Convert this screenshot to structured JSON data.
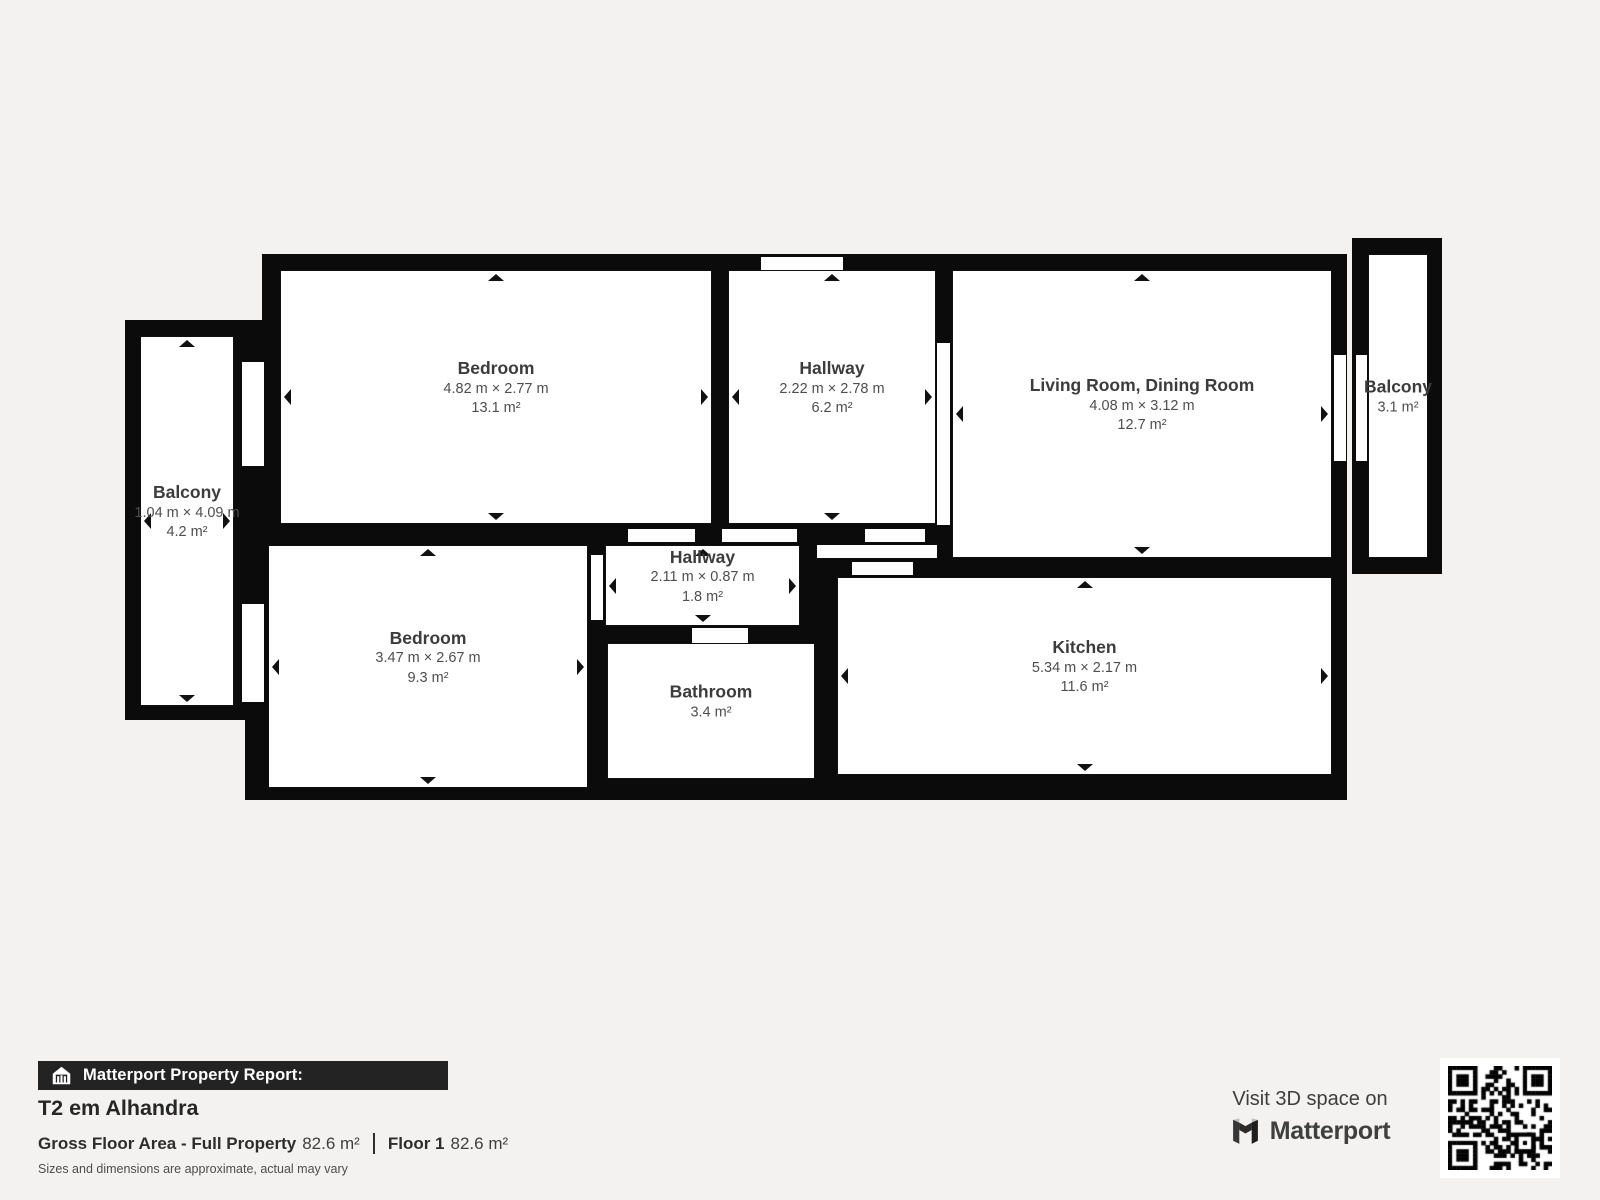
{
  "plan": {
    "wall_color": "#0b0b0b",
    "room_fill": "#ffffff",
    "background": "#f4f2f0",
    "blocks": [
      {
        "x": 262,
        "y": 254,
        "w": 1085,
        "h": 322
      },
      {
        "x": 245,
        "y": 516,
        "w": 1102,
        "h": 284
      },
      {
        "x": 125,
        "y": 320,
        "w": 137,
        "h": 400
      },
      {
        "x": 1352,
        "y": 238,
        "w": 90,
        "h": 336
      }
    ],
    "openings": [
      {
        "type": "window-balcony-left-upper",
        "x": 242,
        "y": 362,
        "w": 22,
        "h": 104
      },
      {
        "type": "window-balcony-left-lower",
        "x": 242,
        "y": 604,
        "w": 22,
        "h": 98
      },
      {
        "type": "window-hallway-top",
        "x": 761,
        "y": 257,
        "w": 82,
        "h": 13
      },
      {
        "type": "door-hallway-living-room",
        "x": 937,
        "y": 343,
        "w": 13,
        "h": 182
      },
      {
        "type": "door-living-room-balcony",
        "x": 1334,
        "y": 355,
        "w": 12,
        "h": 106
      },
      {
        "type": "window-balcony-right",
        "x": 1356,
        "y": 355,
        "w": 11,
        "h": 106
      },
      {
        "type": "door-bedroom-1",
        "x": 628,
        "y": 529,
        "w": 67,
        "h": 13
      },
      {
        "type": "door-hallway-1",
        "x": 722,
        "y": 529,
        "w": 75,
        "h": 13
      },
      {
        "type": "door-kitchen-a",
        "x": 865,
        "y": 529,
        "w": 60,
        "h": 13
      },
      {
        "type": "door-kitchen-b",
        "x": 817,
        "y": 545,
        "w": 120,
        "h": 13
      },
      {
        "type": "door-kitchen-c",
        "x": 852,
        "y": 562,
        "w": 61,
        "h": 13
      },
      {
        "type": "door-bathroom",
        "x": 692,
        "y": 628,
        "w": 56,
        "h": 15
      },
      {
        "type": "door-bedroom-2",
        "x": 591,
        "y": 555,
        "w": 12,
        "h": 65
      }
    ],
    "rooms": [
      {
        "id": "bedroom-1",
        "name": "Bedroom",
        "dims": "4.82 m × 2.77 m",
        "area": "13.1 m²",
        "x": 280,
        "y": 270,
        "w": 432,
        "h": 254,
        "arrows": [
          "up",
          "down",
          "left",
          "right"
        ]
      },
      {
        "id": "hallway-1",
        "name": "Hallway",
        "dims": "2.22 m × 2.78 m",
        "area": "6.2 m²",
        "x": 728,
        "y": 270,
        "w": 208,
        "h": 254,
        "arrows": [
          "up",
          "down",
          "left",
          "right"
        ]
      },
      {
        "id": "living-dining-room",
        "name": "Living Room, Dining Room",
        "dims": "4.08 m × 3.12 m",
        "area": "12.7 m²",
        "x": 952,
        "y": 270,
        "w": 380,
        "h": 288,
        "arrows": [
          "up",
          "down",
          "left",
          "right"
        ]
      },
      {
        "id": "balcony-right",
        "name": "Balcony",
        "dims": "",
        "area": "3.1 m²",
        "x": 1368,
        "y": 254,
        "w": 60,
        "h": 304,
        "arrows": []
      },
      {
        "id": "balcony-left",
        "name": "Balcony",
        "dims": "1.04 m × 4.09 m",
        "area": "4.2 m²",
        "x": 140,
        "y": 336,
        "w": 94,
        "h": 370,
        "arrows": [
          "up",
          "down",
          "left",
          "right"
        ]
      },
      {
        "id": "bedroom-2",
        "name": "Bedroom",
        "dims": "3.47 m × 2.67 m",
        "area": "9.3 m²",
        "x": 268,
        "y": 545,
        "w": 320,
        "h": 243,
        "arrows": [
          "up",
          "down",
          "left",
          "right"
        ]
      },
      {
        "id": "hallway-2",
        "name": "Hallway",
        "dims": "2.11 m × 0.87 m",
        "area": "1.8 m²",
        "x": 605,
        "y": 545,
        "w": 195,
        "h": 81,
        "arrows": [
          "up",
          "down",
          "left",
          "right"
        ]
      },
      {
        "id": "bathroom",
        "name": "Bathroom",
        "dims": "",
        "area": "3.4 m²",
        "x": 607,
        "y": 643,
        "w": 208,
        "h": 136,
        "arrows": []
      },
      {
        "id": "kitchen",
        "name": "Kitchen",
        "dims": "5.34 m × 2.17 m",
        "area": "11.6 m²",
        "x": 837,
        "y": 577,
        "w": 495,
        "h": 198,
        "arrows": [
          "up",
          "down",
          "left",
          "right"
        ]
      }
    ]
  },
  "footer": {
    "report_label": "Matterport Property Report:",
    "title": "T2 em Alhandra",
    "gfa_label": "Gross Floor Area - Full Property",
    "gfa_value": "82.6 m²",
    "floor_label": "Floor 1",
    "floor_value": "82.6 m²",
    "disclaimer": "Sizes and dimensions are approximate, actual may vary"
  },
  "cta": {
    "visit_text": "Visit 3D space on",
    "brand": "Matterport"
  }
}
